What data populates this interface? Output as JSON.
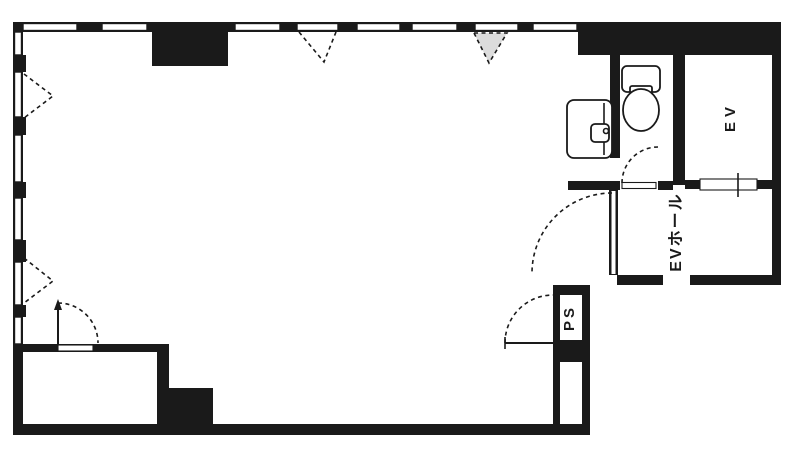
{
  "plan": {
    "labels": {
      "elevator": "EV",
      "elevator_hall": "EVホール",
      "pipe_space": "PS"
    },
    "colors": {
      "wall": "#1a1a1a",
      "background": "#ffffff",
      "window_shade": "#dcdcdc"
    }
  }
}
